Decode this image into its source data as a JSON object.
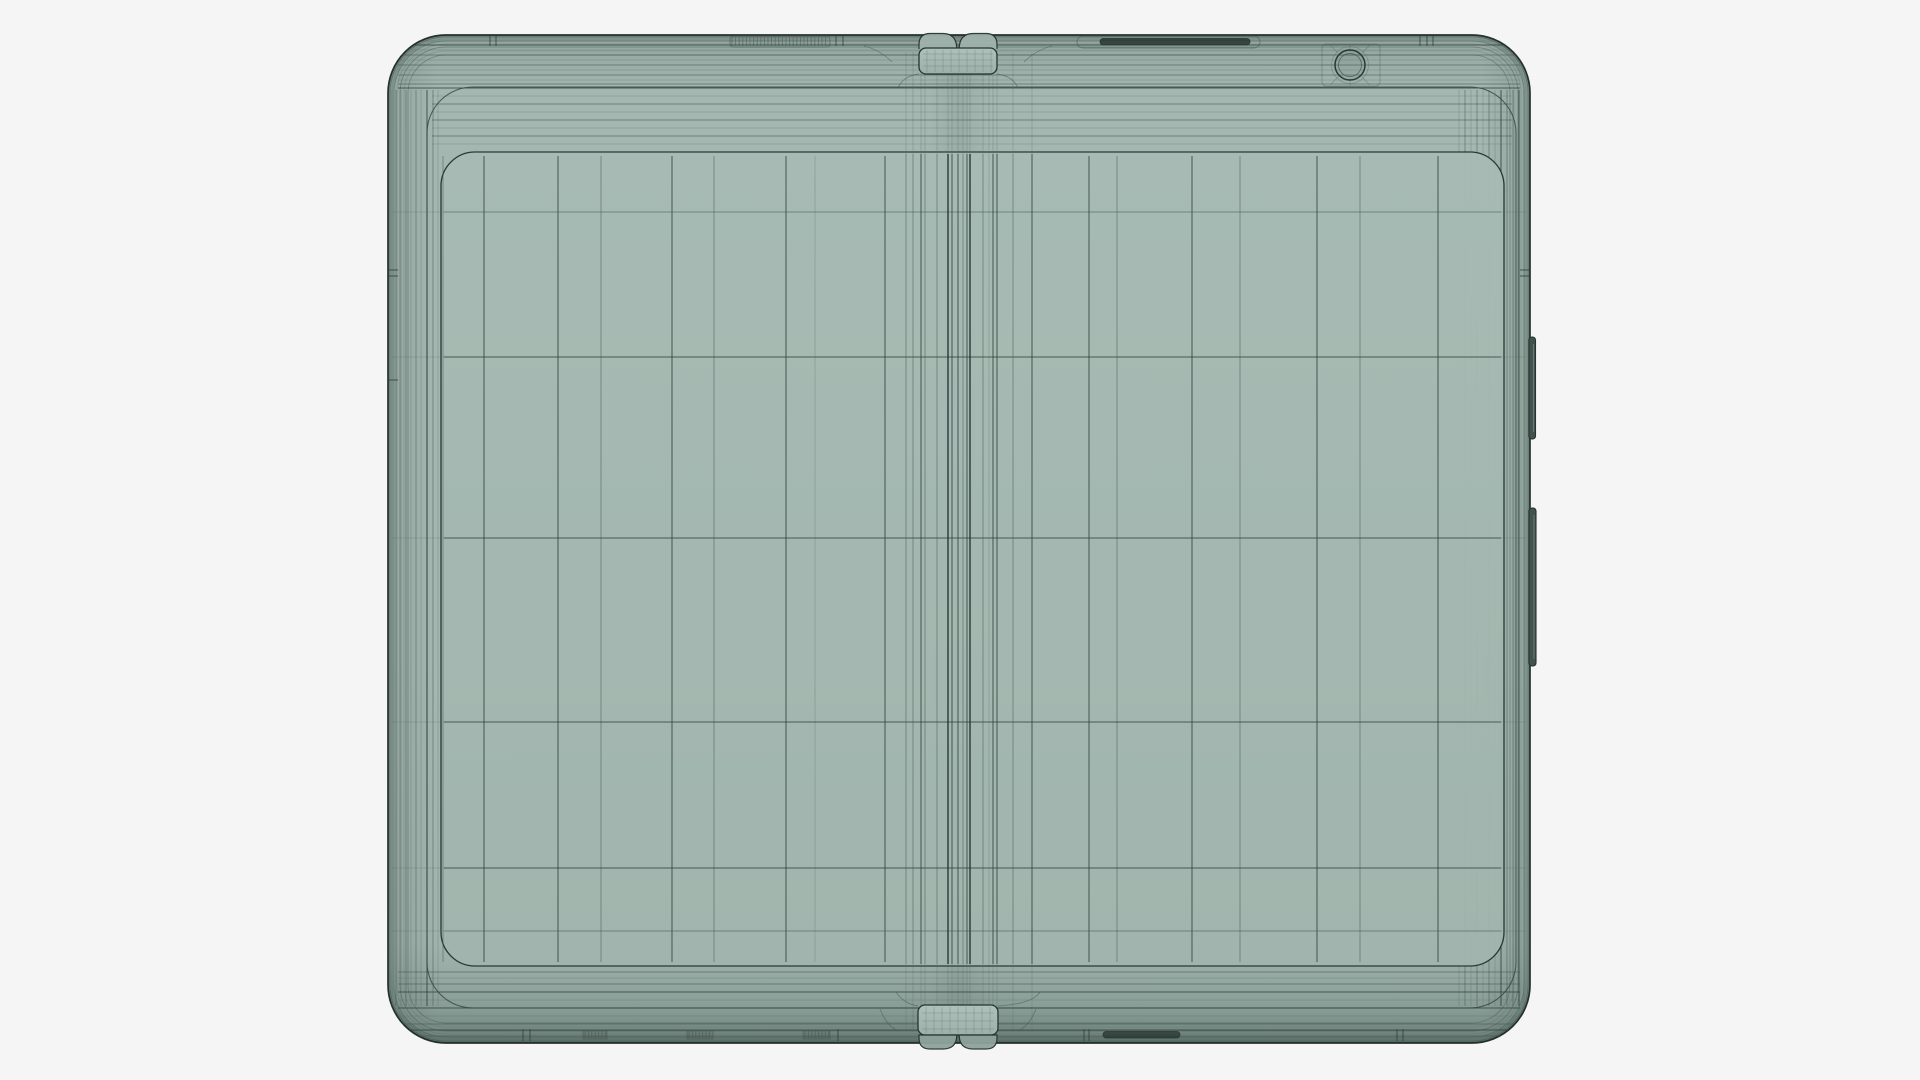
{
  "scene": {
    "description_name": "wireframe-foldable-phone-front-render",
    "background_color": "#f5f5f6"
  },
  "colors": {
    "body_top": "#9cb0a9",
    "body_face": "#a4b8b1",
    "body_low": "#a0b4ad",
    "body_rim_dark": "#81968f",
    "screen_hi": "#a8bcb5",
    "screen_mid": "#a5b9b2",
    "screen_lo": "#a2b6af",
    "tab_fill": "#a9bdb6",
    "bump_top_fill": "#9fb3ac",
    "bump_bottom_fill": "#8ea39c",
    "slot_dark": "#222f2b",
    "button_fill": "#42534f",
    "button_edge": "#26332f",
    "button_highlight": "#8a9d97",
    "shade": "rgba(22,37,32,1)",
    "stroke_strong": "#26332f",
    "stroke_medium": "#33423e",
    "stroke_faint": "#44554f",
    "stroke_hair": "#55665f"
  },
  "strokes": {
    "s": {
      "c": "#26332f",
      "w": 1.45,
      "o": 0.92
    },
    "m": {
      "c": "#33423e",
      "w": 1.05,
      "o": 0.8
    },
    "f": {
      "c": "#44554f",
      "w": 0.9,
      "o": 0.55
    },
    "h": {
      "c": "#55665f",
      "w": 0.8,
      "o": 0.34
    }
  },
  "device": {
    "body": {
      "x": 388,
      "y": 35,
      "w": 1142,
      "h": 1008,
      "rx": 58
    },
    "edge_loop_insets": [
      2,
      4,
      6,
      9,
      12,
      16,
      20
    ],
    "bezel": {
      "x": 427,
      "y": 87,
      "w": 1089,
      "h": 921,
      "rx": 46
    },
    "screen": {
      "x": 441,
      "y": 152,
      "w": 1063,
      "h": 814,
      "rx": 34
    },
    "top_band_h": [
      {
        "y": 41,
        "s": "h"
      },
      {
        "y": 45,
        "s": "m"
      },
      {
        "y": 50,
        "s": "h"
      },
      {
        "y": 55,
        "s": "f"
      },
      {
        "y": 60,
        "s": "h"
      },
      {
        "y": 65,
        "s": "f"
      },
      {
        "y": 70,
        "s": "h"
      },
      {
        "y": 75,
        "s": "f"
      },
      {
        "y": 80,
        "s": "h"
      },
      {
        "y": 84,
        "s": "f"
      },
      {
        "y": 88,
        "s": "m"
      }
    ],
    "transition_h": [
      {
        "y": 96,
        "s": "h"
      },
      {
        "y": 104,
        "s": "f"
      },
      {
        "y": 112,
        "s": "h"
      },
      {
        "y": 120,
        "s": "f"
      },
      {
        "y": 128,
        "s": "h"
      },
      {
        "y": 136,
        "s": "f"
      },
      {
        "y": 144,
        "s": "h"
      }
    ],
    "bottom_band_h": [
      {
        "y": 972,
        "s": "f"
      },
      {
        "y": 978,
        "s": "h"
      },
      {
        "y": 984,
        "s": "f"
      },
      {
        "y": 992,
        "s": "m"
      },
      {
        "y": 1000,
        "s": "h"
      },
      {
        "y": 1008,
        "s": "m"
      },
      {
        "y": 1016,
        "s": "h"
      },
      {
        "y": 1024,
        "s": "f"
      },
      {
        "y": 1030,
        "s": "m"
      },
      {
        "y": 1036,
        "s": "f"
      }
    ],
    "left_dense_v": [
      {
        "x": 392,
        "s": "h"
      },
      {
        "x": 396,
        "s": "f"
      },
      {
        "x": 401,
        "s": "h"
      },
      {
        "x": 406,
        "s": "f"
      },
      {
        "x": 411,
        "s": "h"
      },
      {
        "x": 416,
        "s": "f"
      },
      {
        "x": 421,
        "s": "h"
      },
      {
        "x": 427,
        "s": "m"
      },
      {
        "x": 433,
        "s": "f"
      },
      {
        "x": 438,
        "s": "h"
      }
    ],
    "right_dense_v": [
      {
        "x": 1459,
        "s": "h"
      },
      {
        "x": 1465,
        "s": "f"
      },
      {
        "x": 1471,
        "s": "h"
      },
      {
        "x": 1477,
        "s": "f"
      },
      {
        "x": 1483,
        "s": "h"
      },
      {
        "x": 1489,
        "s": "f"
      },
      {
        "x": 1495,
        "s": "h"
      },
      {
        "x": 1501,
        "s": "m"
      },
      {
        "x": 1507,
        "s": "f"
      },
      {
        "x": 1513,
        "s": "f"
      },
      {
        "x": 1519,
        "s": "m"
      },
      {
        "x": 1524,
        "s": "h"
      }
    ],
    "face_grid_v": [
      {
        "x": 443,
        "s": "f"
      },
      {
        "x": 484,
        "s": "m"
      },
      {
        "x": 558,
        "s": "m"
      },
      {
        "x": 601,
        "s": "f"
      },
      {
        "x": 672,
        "s": "m"
      },
      {
        "x": 714,
        "s": "f"
      },
      {
        "x": 786,
        "s": "m"
      },
      {
        "x": 815,
        "s": "h"
      },
      {
        "x": 885,
        "s": "m"
      },
      {
        "x": 1089,
        "s": "m"
      },
      {
        "x": 1117,
        "s": "f"
      },
      {
        "x": 1192,
        "s": "m"
      },
      {
        "x": 1240,
        "s": "f"
      },
      {
        "x": 1317,
        "s": "m"
      },
      {
        "x": 1360,
        "s": "f"
      },
      {
        "x": 1438,
        "s": "m"
      }
    ],
    "hinge_v": [
      {
        "x": 906,
        "s": "f"
      },
      {
        "x": 913,
        "s": "f"
      },
      {
        "x": 921,
        "s": "m"
      },
      {
        "x": 925,
        "s": "f"
      },
      {
        "x": 937,
        "s": "f"
      },
      {
        "x": 948,
        "s": "s"
      },
      {
        "x": 952,
        "s": "m"
      },
      {
        "x": 958,
        "s": "m"
      },
      {
        "x": 963,
        "s": "f"
      },
      {
        "x": 967,
        "s": "m"
      },
      {
        "x": 970,
        "s": "s"
      },
      {
        "x": 983,
        "s": "f"
      },
      {
        "x": 989,
        "s": "h"
      },
      {
        "x": 993,
        "s": "m"
      },
      {
        "x": 997,
        "s": "m"
      },
      {
        "x": 1013,
        "s": "f"
      },
      {
        "x": 1032,
        "s": "m"
      }
    ],
    "face_grid_h": [
      {
        "y": 212,
        "s": "f"
      },
      {
        "y": 357,
        "s": "m"
      },
      {
        "y": 538,
        "s": "m"
      },
      {
        "y": 722,
        "s": "m"
      },
      {
        "y": 868,
        "s": "m"
      },
      {
        "y": 931,
        "s": "f"
      }
    ],
    "top_tab": {
      "x": 919,
      "y": 48,
      "w": 78,
      "h": 26,
      "r": 7,
      "gap_center": 958
    },
    "bottom_tab": {
      "x": 918,
      "y": 1005,
      "w": 80,
      "h": 30,
      "r": 7,
      "gap_center": 958,
      "bump_y": 1035,
      "bump_h": 14
    },
    "camera": {
      "cx": 1350,
      "cy": 65,
      "r": 15,
      "r_inner": 11.5,
      "r_outer_faint": 18.5,
      "box": {
        "x": 1322,
        "y": 44,
        "w": 58,
        "h": 42
      }
    },
    "buttons": [
      {
        "name": "power-button",
        "x": 1529,
        "y": 337,
        "w": 6.5,
        "h": 102
      },
      {
        "name": "volume-button",
        "x": 1529,
        "y": 508,
        "w": 7,
        "h": 158
      }
    ],
    "top_slots": {
      "hatch_recess": {
        "x": 730,
        "y": 36,
        "w": 100,
        "h": 11
      },
      "speaker_recess": {
        "x": 1077,
        "y": 36,
        "w": 183,
        "h": 12
      },
      "speaker_lens": {
        "x": 1100,
        "y": 38.5,
        "w": 150,
        "h": 6.5
      }
    },
    "bottom_slots": {
      "speaker_lens": {
        "x": 1103,
        "y": 1031.5,
        "w": 77,
        "h": 6.5
      },
      "hatch_bands": [
        {
          "x": 583,
          "w": 24
        },
        {
          "x": 687,
          "w": 26
        },
        {
          "x": 803,
          "w": 27
        }
      ],
      "hatch_y": 1030,
      "hatch_h": 9
    },
    "top_ticks": [
      [
        490,
        496
      ],
      [
        836,
        843
      ],
      [
        1420,
        1427,
        1433
      ]
    ],
    "bottom_ticks": [
      [
        523,
        530
      ],
      [
        838
      ],
      [
        1084,
        1089
      ],
      [
        1397,
        1403
      ]
    ],
    "left_ticks_y": [
      270,
      276,
      380
    ],
    "right_ticks_y": [
      270,
      276
    ]
  }
}
